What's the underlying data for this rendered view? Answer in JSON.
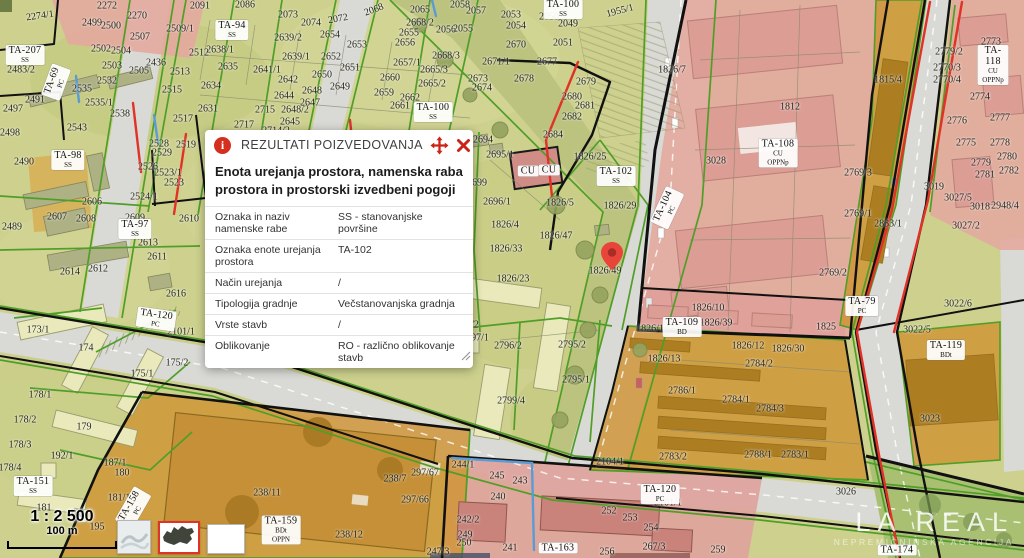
{
  "popup": {
    "title": "REZULTATI POIZVEDOVANJA",
    "heading": "Enota urejanja prostora, namenska raba prostora in prostorski izvedbeni pogoji",
    "icons": [
      "info-circle-icon",
      "move-icon",
      "close-icon"
    ],
    "rows": [
      {
        "label": "Oznaka in naziv namenske rabe",
        "value": "SS - stanovanjske površine"
      },
      {
        "label": "Oznaka enote urejanja prostora",
        "value": "TA-102"
      },
      {
        "label": "Način urejanja",
        "value": "/"
      },
      {
        "label": "Tipologija gradnje",
        "value": "Večstanovanjska gradnja"
      },
      {
        "label": "Vrste stavb",
        "value": "/"
      },
      {
        "label": "Oblikovanje",
        "value": "RO - različno oblikovanje stavb"
      }
    ]
  },
  "scalebar": {
    "ratio": "1 : 2 500",
    "distance": "100 m"
  },
  "watermark": {
    "title": "LA REAL",
    "subtitle": "NEPREMIČNINSKA AGENCIJA"
  },
  "basemaps": [
    {
      "name": "basemap-preview"
    },
    {
      "name": "slovenia-outline",
      "selected": true
    },
    {
      "name": "blank-white"
    }
  ],
  "map": {
    "pin": {
      "x": 612,
      "y": 270
    },
    "colors": {
      "accent_red": "#d4301f",
      "residential_base": "#cdd18d",
      "mixed_use_pink": "#e3a89f",
      "commercial_orange": "#cf9434",
      "road_gray": "#d9d9d5",
      "boundary_green": "#4f9e28"
    },
    "parcel_labels": [
      {
        "t": "2274/1",
        "x": 40,
        "y": 16,
        "r": -8
      },
      {
        "t": "2272",
        "x": 107,
        "y": 6
      },
      {
        "t": "2270",
        "x": 137,
        "y": 16
      },
      {
        "t": "2091",
        "x": 200,
        "y": 6
      },
      {
        "t": "2086",
        "x": 245,
        "y": 5
      },
      {
        "t": "2499",
        "x": 92,
        "y": 23
      },
      {
        "t": "2500",
        "x": 111,
        "y": 26
      },
      {
        "t": "2507",
        "x": 140,
        "y": 37
      },
      {
        "t": "2509/1",
        "x": 180,
        "y": 29
      },
      {
        "t": "2502",
        "x": 101,
        "y": 49
      },
      {
        "t": "2504",
        "x": 121,
        "y": 51
      },
      {
        "t": "2638/1",
        "x": 220,
        "y": 50
      },
      {
        "t": "2503",
        "x": 112,
        "y": 66
      },
      {
        "t": "2436",
        "x": 156,
        "y": 63
      },
      {
        "t": "2512",
        "x": 199,
        "y": 53
      },
      {
        "t": "2513",
        "x": 180,
        "y": 72
      },
      {
        "t": "2635",
        "x": 228,
        "y": 67
      },
      {
        "t": "2505",
        "x": 139,
        "y": 71
      },
      {
        "t": "2532",
        "x": 107,
        "y": 81
      },
      {
        "t": "2634",
        "x": 211,
        "y": 86
      },
      {
        "t": "2515",
        "x": 172,
        "y": 90
      },
      {
        "t": "2535",
        "x": 82,
        "y": 89
      },
      {
        "t": "2535/1",
        "x": 99,
        "y": 103
      },
      {
        "t": "2631",
        "x": 208,
        "y": 109
      },
      {
        "t": "2517",
        "x": 183,
        "y": 119
      },
      {
        "t": "2538",
        "x": 120,
        "y": 114
      },
      {
        "t": "2543",
        "x": 77,
        "y": 128
      },
      {
        "t": "2483/2",
        "x": 21,
        "y": 70
      },
      {
        "t": "2491",
        "x": 35,
        "y": 100
      },
      {
        "t": "2497",
        "x": 13,
        "y": 109
      },
      {
        "t": "2498",
        "x": 10,
        "y": 133
      },
      {
        "t": "2717",
        "x": 244,
        "y": 125
      },
      {
        "t": "2073",
        "x": 288,
        "y": 15
      },
      {
        "t": "2074",
        "x": 311,
        "y": 23
      },
      {
        "t": "2072",
        "x": 338,
        "y": 19,
        "r": -10
      },
      {
        "t": "2068",
        "x": 374,
        "y": 10,
        "r": -20
      },
      {
        "t": "2065",
        "x": 420,
        "y": 10
      },
      {
        "t": "2058",
        "x": 460,
        "y": 5
      },
      {
        "t": "2057",
        "x": 476,
        "y": 11
      },
      {
        "t": "2639/2",
        "x": 288,
        "y": 38
      },
      {
        "t": "2654",
        "x": 330,
        "y": 35
      },
      {
        "t": "2655",
        "x": 409,
        "y": 33
      },
      {
        "t": "2668/2",
        "x": 420,
        "y": 23
      },
      {
        "t": "2056",
        "x": 446,
        "y": 30
      },
      {
        "t": "2055",
        "x": 463,
        "y": 29
      },
      {
        "t": "2653",
        "x": 357,
        "y": 45
      },
      {
        "t": "2656",
        "x": 405,
        "y": 43
      },
      {
        "t": "2668/3",
        "x": 446,
        "y": 56
      },
      {
        "t": "2639/1",
        "x": 296,
        "y": 57
      },
      {
        "t": "2652",
        "x": 331,
        "y": 57
      },
      {
        "t": "2657/1",
        "x": 407,
        "y": 63
      },
      {
        "t": "2671/1",
        "x": 496,
        "y": 62
      },
      {
        "t": "2641/1",
        "x": 267,
        "y": 70
      },
      {
        "t": "2651",
        "x": 350,
        "y": 68
      },
      {
        "t": "2665/3",
        "x": 434,
        "y": 70
      },
      {
        "t": "2642",
        "x": 288,
        "y": 80
      },
      {
        "t": "2650",
        "x": 322,
        "y": 75
      },
      {
        "t": "2660",
        "x": 390,
        "y": 78
      },
      {
        "t": "2665/2",
        "x": 432,
        "y": 84
      },
      {
        "t": "2673",
        "x": 478,
        "y": 79
      },
      {
        "t": "2648",
        "x": 312,
        "y": 91
      },
      {
        "t": "2649",
        "x": 340,
        "y": 87
      },
      {
        "t": "2674",
        "x": 482,
        "y": 88
      },
      {
        "t": "2644",
        "x": 284,
        "y": 96
      },
      {
        "t": "2659",
        "x": 384,
        "y": 93
      },
      {
        "t": "2662",
        "x": 410,
        "y": 98
      },
      {
        "t": "2715",
        "x": 265,
        "y": 110
      },
      {
        "t": "2648/2",
        "x": 295,
        "y": 110
      },
      {
        "t": "2661",
        "x": 400,
        "y": 106
      },
      {
        "t": "2647",
        "x": 310,
        "y": 103
      },
      {
        "t": "2645",
        "x": 290,
        "y": 122
      },
      {
        "t": "2714/2",
        "x": 276,
        "y": 131
      },
      {
        "t": "2053",
        "x": 511,
        "y": 15
      },
      {
        "t": "2050",
        "x": 549,
        "y": 17
      },
      {
        "t": "2049",
        "x": 568,
        "y": 24
      },
      {
        "t": "2054",
        "x": 516,
        "y": 26
      },
      {
        "t": "2051",
        "x": 563,
        "y": 43
      },
      {
        "t": "2670",
        "x": 516,
        "y": 45
      },
      {
        "t": "1955/1",
        "x": 620,
        "y": 11,
        "r": -15
      },
      {
        "t": "2677",
        "x": 547,
        "y": 62
      },
      {
        "t": "2678",
        "x": 524,
        "y": 79
      },
      {
        "t": "2679",
        "x": 586,
        "y": 82
      },
      {
        "t": "2680",
        "x": 572,
        "y": 97
      },
      {
        "t": "2681",
        "x": 585,
        "y": 106
      },
      {
        "t": "2682",
        "x": 572,
        "y": 117
      },
      {
        "t": "1826/7",
        "x": 672,
        "y": 70
      },
      {
        "t": "1812",
        "x": 790,
        "y": 107
      },
      {
        "t": "1815/4",
        "x": 888,
        "y": 80
      },
      {
        "t": "2773",
        "x": 991,
        "y": 42
      },
      {
        "t": "2779/2",
        "x": 949,
        "y": 52
      },
      {
        "t": "2770/3",
        "x": 947,
        "y": 68
      },
      {
        "t": "2770/4",
        "x": 947,
        "y": 80
      },
      {
        "t": "2774",
        "x": 980,
        "y": 97
      },
      {
        "t": "2776",
        "x": 957,
        "y": 121
      },
      {
        "t": "2777",
        "x": 1000,
        "y": 118
      },
      {
        "t": "2775",
        "x": 966,
        "y": 143
      },
      {
        "t": "2778",
        "x": 1000,
        "y": 143
      },
      {
        "t": "2779",
        "x": 981,
        "y": 163
      },
      {
        "t": "2780",
        "x": 1007,
        "y": 157
      },
      {
        "t": "2781",
        "x": 985,
        "y": 175
      },
      {
        "t": "2782",
        "x": 1009,
        "y": 171
      },
      {
        "t": "3019",
        "x": 934,
        "y": 187
      },
      {
        "t": "3027/5",
        "x": 958,
        "y": 198
      },
      {
        "t": "3018",
        "x": 980,
        "y": 207
      },
      {
        "t": "2948/4",
        "x": 1005,
        "y": 206
      },
      {
        "t": "3028",
        "x": 716,
        "y": 161
      },
      {
        "t": "2769/3",
        "x": 858,
        "y": 173
      },
      {
        "t": "2769/1",
        "x": 858,
        "y": 214
      },
      {
        "t": "2833/1",
        "x": 888,
        "y": 224
      },
      {
        "t": "3027/2",
        "x": 966,
        "y": 226
      },
      {
        "t": "2769/2",
        "x": 833,
        "y": 273
      },
      {
        "t": "1825",
        "x": 826,
        "y": 327
      },
      {
        "t": "2694",
        "x": 483,
        "y": 140
      },
      {
        "t": "2684",
        "x": 553,
        "y": 135
      },
      {
        "t": "2695/1",
        "x": 500,
        "y": 155
      },
      {
        "t": "1826/25",
        "x": 590,
        "y": 157
      },
      {
        "t": "2699",
        "x": 477,
        "y": 183
      },
      {
        "t": "2696/1",
        "x": 497,
        "y": 202
      },
      {
        "t": "1826/5",
        "x": 560,
        "y": 203
      },
      {
        "t": "1826/29",
        "x": 620,
        "y": 206
      },
      {
        "t": "1826/4",
        "x": 505,
        "y": 225
      },
      {
        "t": "1826/47",
        "x": 556,
        "y": 236
      },
      {
        "t": "1826/33",
        "x": 506,
        "y": 249
      },
      {
        "t": "1826/23",
        "x": 513,
        "y": 279
      },
      {
        "t": "1826/49",
        "x": 605,
        "y": 271
      },
      {
        "t": "2490",
        "x": 24,
        "y": 162
      },
      {
        "t": "2519",
        "x": 186,
        "y": 145
      },
      {
        "t": "2528",
        "x": 159,
        "y": 144
      },
      {
        "t": "2529",
        "x": 162,
        "y": 153
      },
      {
        "t": "2526",
        "x": 148,
        "y": 167
      },
      {
        "t": "2523/1",
        "x": 168,
        "y": 173
      },
      {
        "t": "2523",
        "x": 174,
        "y": 183
      },
      {
        "t": "2524/1",
        "x": 144,
        "y": 197
      },
      {
        "t": "2606",
        "x": 92,
        "y": 202
      },
      {
        "t": "2607",
        "x": 57,
        "y": 217
      },
      {
        "t": "2608",
        "x": 86,
        "y": 219
      },
      {
        "t": "2609",
        "x": 135,
        "y": 218
      },
      {
        "t": "2610",
        "x": 189,
        "y": 219
      },
      {
        "t": "2489",
        "x": 12,
        "y": 227
      },
      {
        "t": "2613",
        "x": 148,
        "y": 243
      },
      {
        "t": "2611",
        "x": 157,
        "y": 257
      },
      {
        "t": "2612",
        "x": 98,
        "y": 269
      },
      {
        "t": "2614",
        "x": 70,
        "y": 272
      },
      {
        "t": "2616",
        "x": 176,
        "y": 294
      },
      {
        "t": "173/1",
        "x": 38,
        "y": 330
      },
      {
        "t": "2101/1",
        "x": 181,
        "y": 332
      },
      {
        "t": "174",
        "x": 86,
        "y": 348
      },
      {
        "t": "175/2",
        "x": 177,
        "y": 363
      },
      {
        "t": "175/1",
        "x": 142,
        "y": 374
      },
      {
        "t": "178/1",
        "x": 40,
        "y": 395
      },
      {
        "t": "178/2",
        "x": 25,
        "y": 420
      },
      {
        "t": "179",
        "x": 84,
        "y": 427
      },
      {
        "t": "178/3",
        "x": 20,
        "y": 445
      },
      {
        "t": "192/1",
        "x": 62,
        "y": 456
      },
      {
        "t": "187/1",
        "x": 115,
        "y": 463
      },
      {
        "t": "178/4",
        "x": 10,
        "y": 468
      },
      {
        "t": "180",
        "x": 122,
        "y": 473
      },
      {
        "t": "181",
        "x": 44,
        "y": 508
      },
      {
        "t": "182",
        "x": 77,
        "y": 514
      },
      {
        "t": "181/1",
        "x": 119,
        "y": 498
      },
      {
        "t": "195",
        "x": 97,
        "y": 527
      },
      {
        "t": "2792/2",
        "x": 465,
        "y": 325
      },
      {
        "t": "2797/1",
        "x": 475,
        "y": 338
      },
      {
        "t": "2796/2",
        "x": 508,
        "y": 346
      },
      {
        "t": "2795/2",
        "x": 572,
        "y": 345
      },
      {
        "t": "2795/1",
        "x": 576,
        "y": 380
      },
      {
        "t": "2799/4",
        "x": 511,
        "y": 401
      },
      {
        "t": "1826/10",
        "x": 708,
        "y": 308
      },
      {
        "t": "1826/39",
        "x": 716,
        "y": 323
      },
      {
        "t": "1826/12",
        "x": 748,
        "y": 346
      },
      {
        "t": "1826/30",
        "x": 788,
        "y": 349
      },
      {
        "t": "1826/1",
        "x": 650,
        "y": 329
      },
      {
        "t": "1826/13",
        "x": 664,
        "y": 359
      },
      {
        "t": "2784/2",
        "x": 759,
        "y": 364
      },
      {
        "t": "2786/1",
        "x": 682,
        "y": 391
      },
      {
        "t": "2784/1",
        "x": 736,
        "y": 400
      },
      {
        "t": "2784/3",
        "x": 770,
        "y": 409
      },
      {
        "t": "2783/2",
        "x": 673,
        "y": 457
      },
      {
        "t": "2788/1",
        "x": 758,
        "y": 455
      },
      {
        "t": "2783/1",
        "x": 795,
        "y": 455
      },
      {
        "t": "2104/1",
        "x": 610,
        "y": 462
      },
      {
        "t": "3026",
        "x": 846,
        "y": 492
      },
      {
        "t": "2101/1",
        "x": 668,
        "y": 503
      },
      {
        "t": "238/11",
        "x": 267,
        "y": 493
      },
      {
        "t": "238/7",
        "x": 395,
        "y": 479
      },
      {
        "t": "297/67",
        "x": 425,
        "y": 473
      },
      {
        "t": "297/66",
        "x": 415,
        "y": 500
      },
      {
        "t": "238/12",
        "x": 349,
        "y": 535
      },
      {
        "t": "244/1",
        "x": 463,
        "y": 465
      },
      {
        "t": "245",
        "x": 497,
        "y": 476
      },
      {
        "t": "243",
        "x": 520,
        "y": 481
      },
      {
        "t": "240",
        "x": 498,
        "y": 497
      },
      {
        "t": "242/2",
        "x": 468,
        "y": 520
      },
      {
        "t": "249",
        "x": 465,
        "y": 535
      },
      {
        "t": "250",
        "x": 464,
        "y": 543
      },
      {
        "t": "241",
        "x": 510,
        "y": 548
      },
      {
        "t": "247/3",
        "x": 438,
        "y": 552
      },
      {
        "t": "256",
        "x": 607,
        "y": 552
      },
      {
        "t": "252",
        "x": 609,
        "y": 511
      },
      {
        "t": "253",
        "x": 630,
        "y": 518
      },
      {
        "t": "254",
        "x": 651,
        "y": 528
      },
      {
        "t": "267/3",
        "x": 654,
        "y": 547
      },
      {
        "t": "259",
        "x": 718,
        "y": 550
      },
      {
        "t": "3022/6",
        "x": 958,
        "y": 304
      },
      {
        "t": "3022/5",
        "x": 917,
        "y": 330
      },
      {
        "t": "3023",
        "x": 930,
        "y": 419
      }
    ],
    "zone_labels": [
      {
        "t": "TA-94",
        "sub": [
          "SS"
        ],
        "x": 232,
        "y": 30
      },
      {
        "t": "TA-207",
        "sub": [
          "SS"
        ],
        "x": 25,
        "y": 55
      },
      {
        "t": "TA-69",
        "sub": [
          "PC"
        ],
        "x": 56,
        "y": 82,
        "r": -70
      },
      {
        "t": "TA-98",
        "sub": [
          "SS"
        ],
        "x": 68,
        "y": 160
      },
      {
        "t": "TA-97",
        "sub": [
          "SS"
        ],
        "x": 135,
        "y": 229
      },
      {
        "t": "TA-100",
        "sub": [
          "SS"
        ],
        "x": 563,
        "y": 9
      },
      {
        "t": "TA-100",
        "sub": [
          "SS"
        ],
        "x": 433,
        "y": 112
      },
      {
        "t": "TA-102",
        "sub": [
          "SS"
        ],
        "x": 616,
        "y": 176
      },
      {
        "t": "TA-104",
        "sub": [
          "PC"
        ],
        "x": 667,
        "y": 208,
        "r": -65
      },
      {
        "t": "TA-108",
        "sub": [
          "CU",
          "OPPNp"
        ],
        "x": 778,
        "y": 153
      },
      {
        "t": "TA-118",
        "sub": [
          "CU",
          "OPPNp"
        ],
        "x": 993,
        "y": 65
      },
      {
        "t": "TA-109",
        "sub": [
          "BD"
        ],
        "x": 682,
        "y": 327
      },
      {
        "t": "TA-79",
        "sub": [
          "PC"
        ],
        "x": 862,
        "y": 306
      },
      {
        "t": "TA-119",
        "sub": [
          "BDt"
        ],
        "x": 946,
        "y": 350
      },
      {
        "t": "TA-120",
        "sub": [
          "PC"
        ],
        "x": 156,
        "y": 319,
        "r": 8
      },
      {
        "t": "TA-120",
        "sub": [
          "PC"
        ],
        "x": 660,
        "y": 494
      },
      {
        "t": "TA-151",
        "sub": [
          "SS"
        ],
        "x": 33,
        "y": 486
      },
      {
        "t": "TA-158",
        "sub": [
          "PC"
        ],
        "x": 133,
        "y": 508,
        "r": -60
      },
      {
        "t": "TA-159",
        "sub": [
          "BDt",
          "OPPN"
        ],
        "x": 281,
        "y": 530
      },
      {
        "t": "TA-163",
        "sub": [],
        "x": 558,
        "y": 548
      },
      {
        "t": "TA-174",
        "sub": [],
        "x": 897,
        "y": 550
      },
      {
        "t": "CU",
        "sub": [],
        "x": 528,
        "y": 171
      },
      {
        "t": "CU",
        "sub": [],
        "x": 549,
        "y": 170
      }
    ]
  }
}
